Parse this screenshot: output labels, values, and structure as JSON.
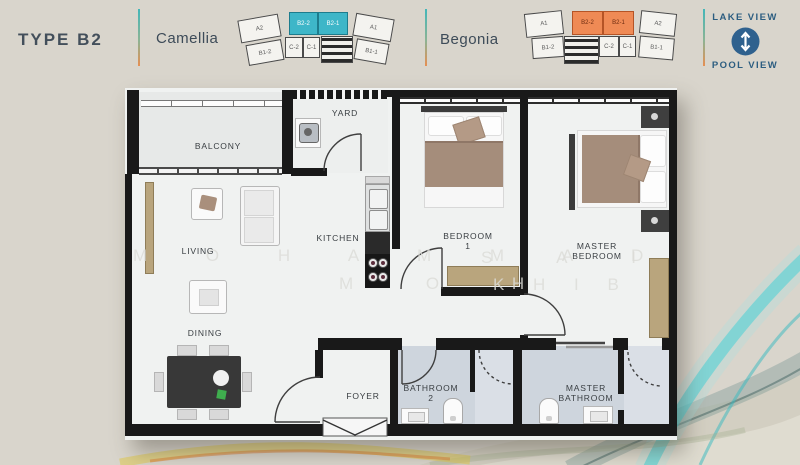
{
  "header": {
    "type_label": "TYPE B2",
    "camellia": {
      "name": "Camellia",
      "highlight_color": "#3eb6c8",
      "units": [
        "A2",
        "B2-2",
        "B2-1",
        "A1",
        "B1-2",
        "C-2",
        "C-1",
        "B1-1"
      ],
      "highlighted_units": [
        "B2-2",
        "B2-1"
      ]
    },
    "begonia": {
      "name": "Begonia",
      "highlight_color": "#ef8a55",
      "units": [
        "A1",
        "B2-2",
        "B2-1",
        "A2",
        "B1-2",
        "C-2",
        "C-1",
        "B1-1"
      ],
      "highlighted_units": [
        "B2-2",
        "B2-1"
      ]
    },
    "views": {
      "top": "LAKE VIEW",
      "bottom": "POOL VIEW"
    }
  },
  "floorplan": {
    "rooms": {
      "balcony": "BALCONY",
      "yard": "YARD",
      "living": "LIVING",
      "kitchen": "KITCHEN",
      "dining": "DINING",
      "foyer": "FOYER",
      "bedroom1_l1": "BEDROOM",
      "bedroom1_l2": "1",
      "master_bedroom_l1": "MASTER",
      "master_bedroom_l2": "BEDROOM",
      "bathroom2_l1": "BATHROOM",
      "bathroom2_l2": "2",
      "master_bathroom_l1": "MASTER",
      "master_bathroom_l2": "BATHROOM"
    }
  },
  "watermark": {
    "line1_part1": "M O H A M M A D",
    "line1_part2": "S A I",
    "line2_part1": "M O H",
    "line2_part2": "K H I B"
  },
  "colors": {
    "background": "#d9d5cc",
    "wall": "#191919",
    "bathroom_floor": "#ced5dd",
    "teal_highlight": "#3eb6c8",
    "orange_highlight": "#ef8a55",
    "view_text": "#2c5d80",
    "view_icon_bg": "#2f618e",
    "accent_yellow": "#e0cb52",
    "accent_teal": "#52d2d6"
  }
}
